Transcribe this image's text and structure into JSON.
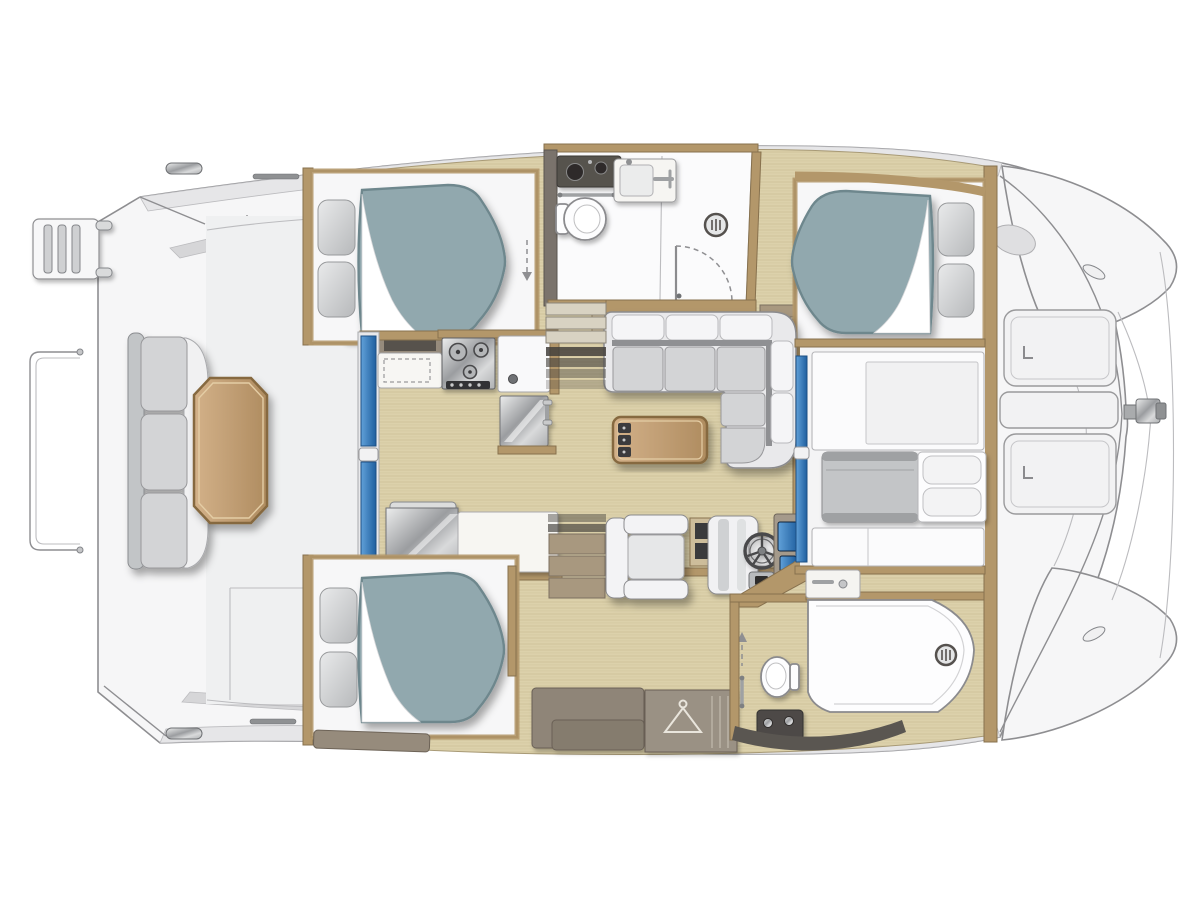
{
  "meta": {
    "title": "Catamaran yacht interior layout — overhead floor plan",
    "view": "top-down",
    "orientation": "bow right, stern left"
  },
  "colors": {
    "page_bg": "#ffffff",
    "hull_fill": "#f6f6f7",
    "hull_line": "#8e8e91",
    "hull_line_soft": "#bcbcbf",
    "deck_band": "#e6e6e8",
    "deck_band_dark": "#d6d6d8",
    "cockpit_floor": "#eff0f1",
    "wood_floor": "#dcd1ab",
    "wood_grain": "#c8bb92",
    "wood_trim": "#b3976a",
    "wood_trim_dark": "#87714e",
    "taupe": "#968b7c",
    "taupe_dark": "#6d6357",
    "charcoal": "#56524e",
    "white_int": "#f7f7f8",
    "mattress": "#91a8ae",
    "mattress_dark": "#6e878d",
    "sofa_base": "#e9e9eb",
    "sofa_seat": "#d3d4d6",
    "sofa_gap": "#8f9093",
    "cushion_white": "#f5f5f7",
    "step_tan": "#a8987f",
    "shadow_bar": "#43403b",
    "ceramic": "#fdfdfe"
  },
  "rooms": {
    "cockpit": {
      "name": "aft cockpit",
      "features": [
        "bench-seat-3-cushions",
        "octagonal-wood-table",
        "aft-facing-seat",
        "swim-ladder",
        "stern-rail",
        "davit-posts"
      ]
    },
    "salon": {
      "name": "salon and galley",
      "features": [
        "sliding-glass-door",
        "l-shaped-galley",
        "stove-3-burners",
        "galley-sink",
        "mirror-front-refrigerator",
        "top-load-fridge-counter",
        "l-shaped-sofa",
        "coffee-table-with-drawers",
        "armchair",
        "helm-seat",
        "steering-wheel",
        "instrument-screens",
        "companionway-steps-starboard",
        "companionway-steps-port"
      ]
    },
    "starboard_hull": {
      "name": "starboard hull (top)",
      "features": [
        "aft-double-berth",
        "pillows",
        "head-with-vanity",
        "toilet",
        "sink-unit",
        "shower-drain",
        "door-swing",
        "corridor-cabinet",
        "forward-double-berth"
      ]
    },
    "port_hull": {
      "name": "port hull (bottom)",
      "features": [
        "aft-double-berth",
        "pillows",
        "storage-cabinets",
        "hanging-wardrobe",
        "forward-head",
        "toilet",
        "shower-pan-with-drain",
        "dark-vanity"
      ]
    },
    "forward_stateroom": {
      "name": "forward stateroom nacelle",
      "features": [
        "berth-with-blanket",
        "pillows",
        "storage-panels",
        "blue-door",
        "counter-with-faucet"
      ]
    },
    "foredeck": {
      "name": "foredeck and bow",
      "features": [
        "deck-locker-upper",
        "deck-locker-strip",
        "deck-locker-lower",
        "anchor-windlass",
        "bow-tips",
        "trampoline-beams",
        "cleats"
      ]
    }
  }
}
